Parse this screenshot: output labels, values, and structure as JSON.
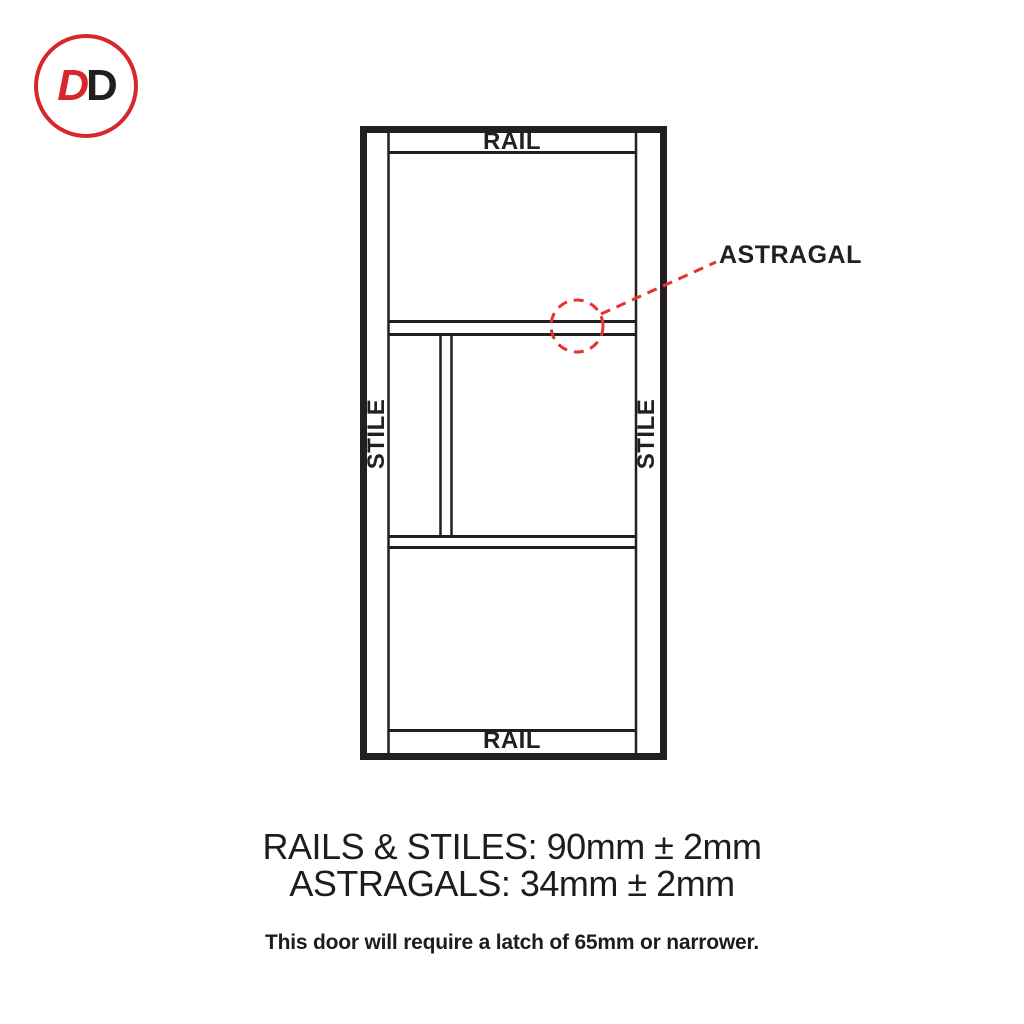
{
  "logo": {
    "letter1": "D",
    "letter2": "D",
    "circle_color": "#d7262c",
    "letter1_color": "#d7262c",
    "letter2_color": "#231f20"
  },
  "door": {
    "rail_top_label": "RAIL",
    "rail_bottom_label": "RAIL",
    "stile_left_label": "STILE",
    "stile_right_label": "STILE",
    "astragal_label": "ASTRAGAL",
    "line_color": "#231f20",
    "callout_color": "#e6342c"
  },
  "specs": {
    "rails_stiles_line": "RAILS & STILES: 90mm ± 2mm",
    "astragals_line": "ASTRAGALS: 34mm ± 2mm",
    "latch_note": "This door will require a latch of 65mm or narrower."
  }
}
